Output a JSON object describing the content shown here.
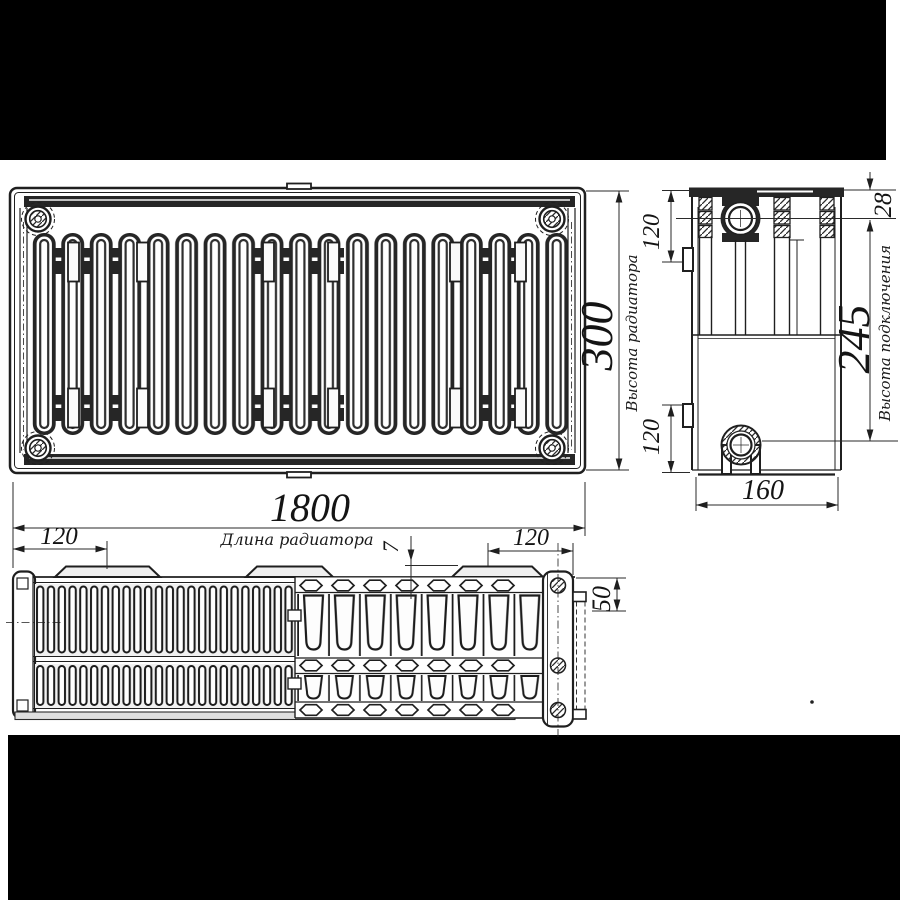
{
  "drawing": {
    "colors": {
      "background": "#000000",
      "paper": "#ffffff",
      "line": "#1f1f1f"
    },
    "dims": {
      "length": "1800",
      "height": "300",
      "connection_height": "245",
      "depth": "160",
      "collector_offset": "28",
      "side_top": "120",
      "side_bottom": "120",
      "bottom_left": "120",
      "bottom_right": "120",
      "panel_gap": "7",
      "panel_depth": "50"
    },
    "labels": {
      "length": "Длина радиатора",
      "height": "Высота радиатора",
      "connection_height": "Высота подключения"
    }
  }
}
